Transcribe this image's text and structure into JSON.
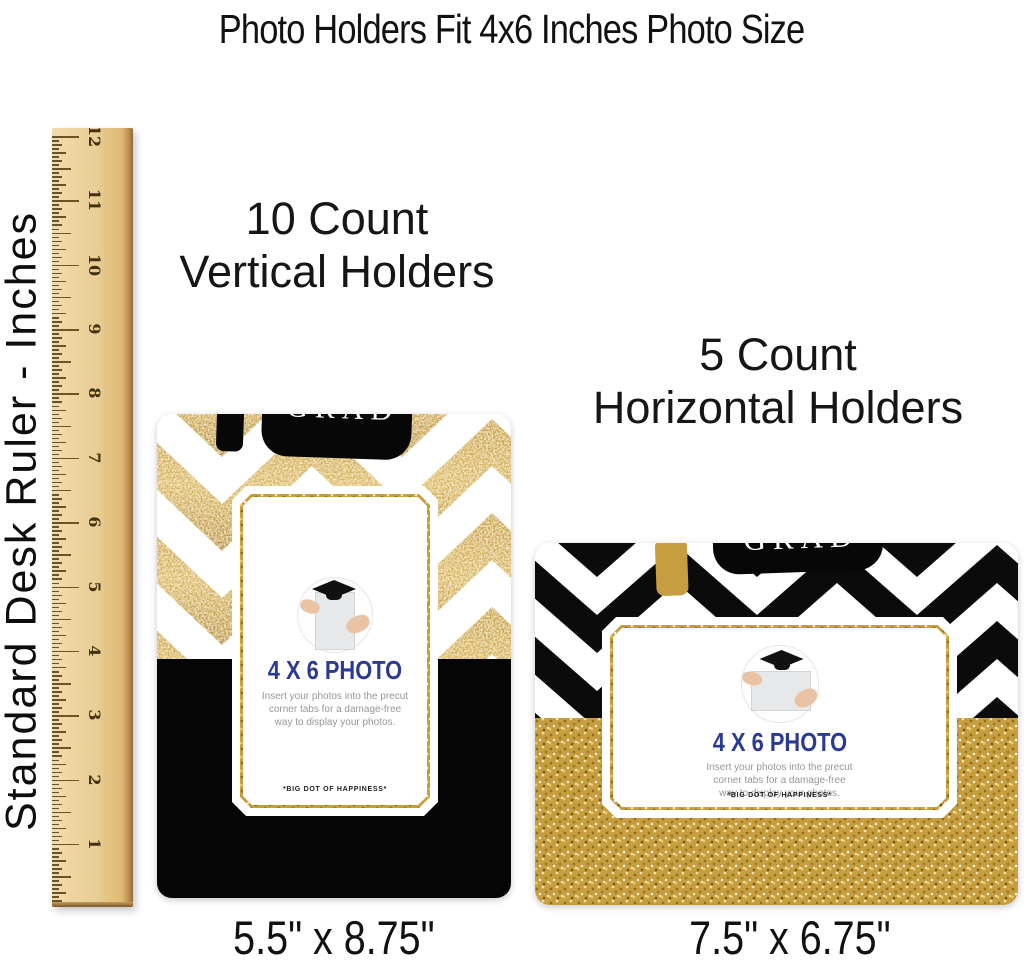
{
  "page": {
    "title": "Photo Holders Fit 4x6 Inches Photo Size"
  },
  "ruler": {
    "label": "Standard Desk Ruler - Inches",
    "numbers": [
      "12",
      "11",
      "10",
      "9",
      "8",
      "7",
      "6",
      "5",
      "4",
      "3",
      "2",
      "1"
    ]
  },
  "vertical_holder": {
    "heading_line1": "10 Count",
    "heading_line2": "Vertical Holders",
    "dimensions": "5.5\" x 8.75\""
  },
  "horizontal_holder": {
    "heading_line1": "5 Count",
    "heading_line2": "Horizontal Holders",
    "dimensions": "7.5\" x 6.75\""
  },
  "card": {
    "cap_script": "congrats",
    "cap_word": "GRAD",
    "photo_size_label": "4 X 6 PHOTO",
    "insert_line1": "Insert your photos into the precut",
    "insert_line2": "corner tabs for a damage-free",
    "insert_line3": "way to display your photos.",
    "brand": "*BIG DOT OF HAPPINESS*"
  },
  "colors": {
    "gold": "#c79e3f",
    "navy": "#2b3a93",
    "black": "#000000",
    "white": "#ffffff"
  }
}
